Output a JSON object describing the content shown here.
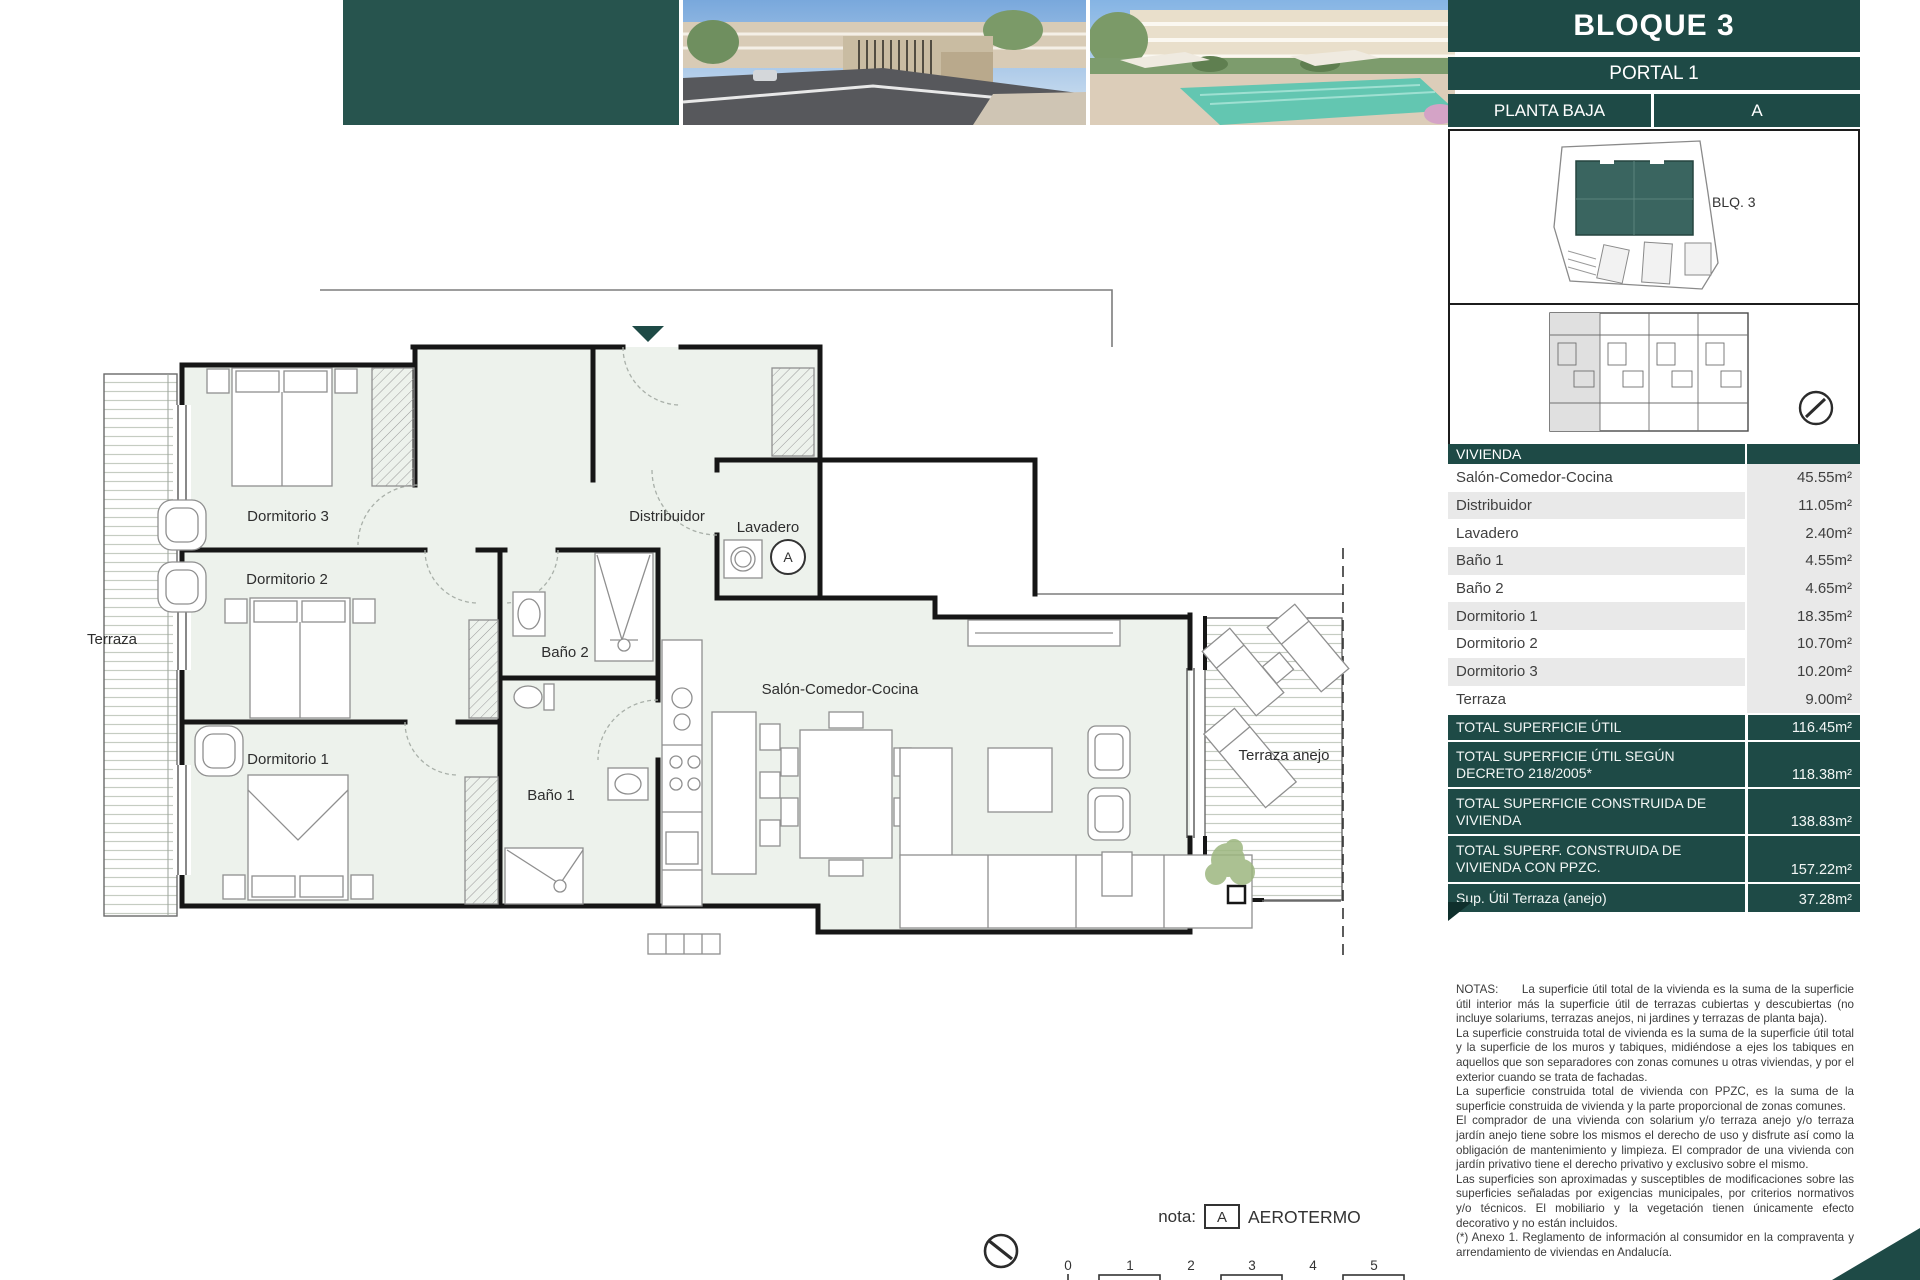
{
  "header": {
    "title": "BLOQUE 3",
    "portal": "PORTAL 1",
    "floor": "PLANTA BAJA",
    "unit": "A",
    "images": [
      {
        "name": "street-entrance-render"
      },
      {
        "name": "pool-garden-render"
      }
    ]
  },
  "site_plan": {
    "block_label": "BLQ. 3"
  },
  "plan": {
    "terraza": "Terraza",
    "dormitorio3": "Dormitorio 3",
    "dormitorio2": "Dormitorio 2",
    "dormitorio1": "Dormitorio 1",
    "bano2": "Baño 2",
    "bano1": "Baño 1",
    "distribuidor": "Distribuidor",
    "lavadero": "Lavadero",
    "salon": "Salón-Comedor-Cocina",
    "terraza_anejo": "Terraza anejo",
    "aerotermo_mark": "A"
  },
  "table": {
    "header": "VIVIENDA",
    "rows": [
      {
        "label": "Salón-Comedor-Cocina",
        "value": "45.55m²"
      },
      {
        "label": "Distribuidor",
        "value": "11.05m²"
      },
      {
        "label": "Lavadero",
        "value": "2.40m²"
      },
      {
        "label": "Baño 1",
        "value": "4.55m²"
      },
      {
        "label": "Baño 2",
        "value": "4.65m²"
      },
      {
        "label": "Dormitorio 1",
        "value": "18.35m²"
      },
      {
        "label": "Dormitorio 2",
        "value": "10.70m²"
      },
      {
        "label": "Dormitorio 3",
        "value": "10.20m²"
      },
      {
        "label": "Terraza",
        "value": "9.00m²"
      }
    ],
    "totals": [
      {
        "label": "TOTAL SUPERFICIE ÚTIL",
        "value": "116.45m²"
      },
      {
        "label": "TOTAL SUPERFICIE ÚTIL SEGÚN DECRETO 218/2005*",
        "value": "118.38m²"
      },
      {
        "label": "TOTAL SUPERFICIE CONSTRUIDA DE VIVIENDA",
        "value": "138.83m²"
      },
      {
        "label": "TOTAL SUPERF. CONSTRUIDA DE VIVIENDA CON PPZC.",
        "value": "157.22m²"
      },
      {
        "label": "Sup. Útil Terraza (anejo)",
        "value": "37.28m²"
      }
    ]
  },
  "notes": {
    "p1": "NOTAS:      La superficie útil total de la vivienda es la suma de la superficie útil interior más la superficie útil de terrazas cubiertas y descubiertas (no incluye solariums, terrazas anejos, ni jardines y terrazas de planta baja).",
    "p2": "La superficie construida total de vivienda es la suma de la superficie útil total y la superficie de los muros y tabiques, midiéndose a ejes los tabiques en aquellos que son separadores con zonas comunes u otras viviendas, y por el exterior cuando se trata de fachadas.",
    "p3": "La superficie construida total de vivienda con PPZC, es la suma de la superficie construida de vivienda y la parte proporcional de zonas comunes.",
    "p4": "El comprador de una vivienda con solarium y/o terraza anejo y/o terraza jardín anejo tiene sobre los mismos el derecho de uso y disfrute así como la obligación de mantenimiento y limpieza. El comprador de una vivienda con jardín privativo tiene el derecho privativo y exclusivo sobre el mismo.",
    "p5": "Las superficies son aproximadas y susceptibles de modificaciones sobre las superficies señaladas por exigencias municipales, por criterios normativos y/o técnicos. El mobiliario y la vegetación tienen únicamente efecto decorativo y no están incluidos.",
    "p6": "(*) Anexo 1. Reglamento de información al consumidor en la compraventa y arrendamiento de viviendas en Andalucía."
  },
  "footer": {
    "nota_label": "nota:",
    "key": "A",
    "key_label": "AEROTERMO",
    "scale_ticks": [
      "0",
      "1",
      "2",
      "3",
      "4",
      "5"
    ]
  },
  "colors": {
    "teal_dark": "#1e4a46",
    "teal_block": "#27544e",
    "site_building": "#3a6560",
    "row_gray": "#e9e9e9",
    "room_fill": "#edf2ec",
    "wall": "#161616"
  }
}
